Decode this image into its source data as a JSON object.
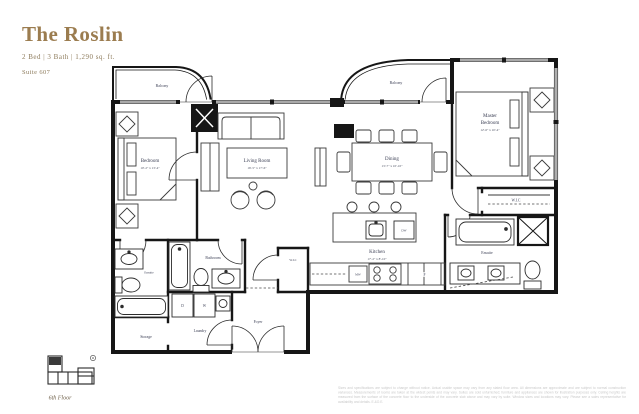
{
  "header": {
    "title": "The Roslin",
    "specs": "2 Bed | 3 Bath | 1,290 sq. ft.",
    "suite": "Suite 607"
  },
  "rooms": {
    "balcony_left": {
      "label": "Balcony"
    },
    "balcony_right": {
      "label": "Balcony"
    },
    "bedroom": {
      "label": "Bedroom",
      "dims": "10'-2\" x 13'-4\""
    },
    "living_room": {
      "label": "Living Room",
      "dims": "16'-5\" x 17'-6\""
    },
    "dining": {
      "label": "Dining",
      "dims": "13'-7\" x 10'-10\""
    },
    "master_bedroom": {
      "label_line1": "Master",
      "label_line2": "Bedroom",
      "dims": "12'-6\" x 10'-4\""
    },
    "kitchen": {
      "label": "Kitchen",
      "dims": "17'-2\" x 8'-10\""
    },
    "wic_master": {
      "label": "W.I.C"
    },
    "wic_hall": {
      "label": "W.I.C"
    },
    "ensuite_master": {
      "label": "Ensuite"
    },
    "ensuite_bedroom": {
      "label": "Ensuite"
    },
    "bathroom": {
      "label": "Bathroom"
    },
    "laundry": {
      "label": "Laundry"
    },
    "storage": {
      "label": "Storage"
    },
    "foyer": {
      "label": "Foyer"
    }
  },
  "appliances": {
    "fridge": "F",
    "dishwasher": "DW",
    "microwave": "MW",
    "dryer": "D",
    "washer": "W"
  },
  "keyplan": {
    "caption": "6th Floor"
  },
  "disclaimer": "Sizes and specifications are subject to change without notice. Actual usable space may vary from any stated floor area. All dimensions are approximate and are subject to normal construction variances. Measurements of rooms are taken at the widest points and may vary. Suites are sold unfurnished; furniture and appliances are shown for illustration purposes only. Ceiling heights are measured from the surface of the concrete floor to the underside of the concrete slab above and may vary by suite. Window sizes and locations may vary. Please see a sales representative for availability and details. E.&O.E.",
  "colors": {
    "accent_gold": "#9b7c4f",
    "plan_line": "#161616",
    "label_text": "#3d4156",
    "muted_text": "#8e7c5d",
    "disclaimer_text": "#c9c9c9"
  }
}
